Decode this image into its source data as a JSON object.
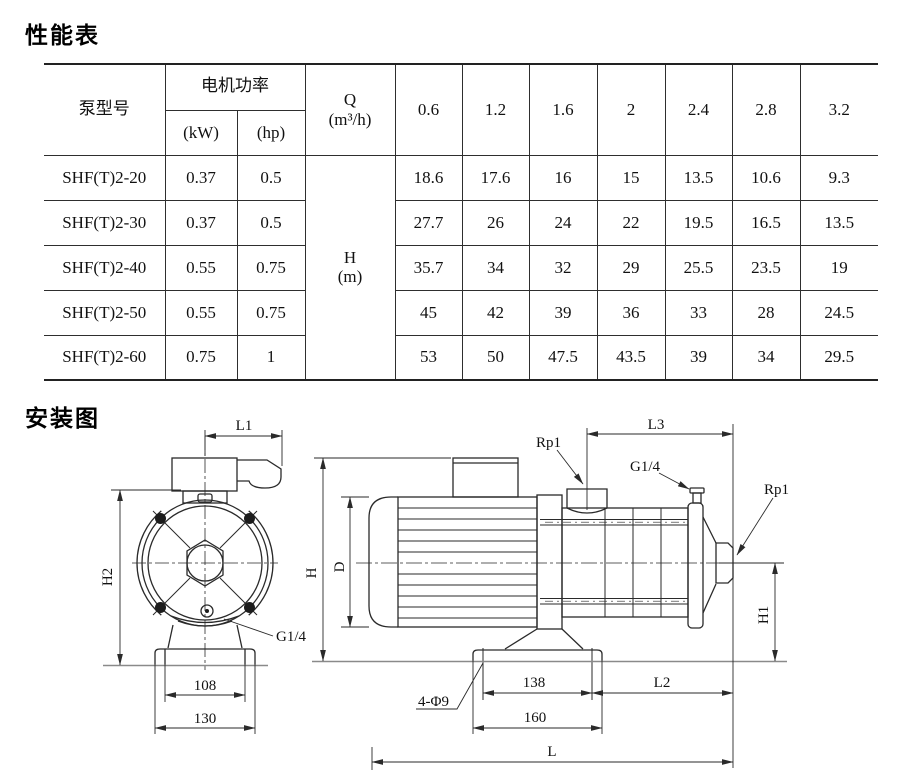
{
  "performance": {
    "title": "性能表",
    "header": {
      "pump_model": "泵型号",
      "motor_power": "电机功率",
      "kw": "(kW)",
      "hp": "(hp)",
      "q": "Q",
      "q_unit": "(m³/h)",
      "q_values": [
        "0.6",
        "1.2",
        "1.6",
        "2",
        "2.4",
        "2.8",
        "3.2"
      ]
    },
    "h_label": {
      "line1": "H",
      "line2": "(m)"
    },
    "rows": [
      {
        "model": "SHF(T)2-20",
        "kw": "0.37",
        "hp": "0.5",
        "h": [
          "18.6",
          "17.6",
          "16",
          "15",
          "13.5",
          "10.6",
          "9.3"
        ]
      },
      {
        "model": "SHF(T)2-30",
        "kw": "0.37",
        "hp": "0.5",
        "h": [
          "27.7",
          "26",
          "24",
          "22",
          "19.5",
          "16.5",
          "13.5"
        ]
      },
      {
        "model": "SHF(T)2-40",
        "kw": "0.55",
        "hp": "0.75",
        "h": [
          "35.7",
          "34",
          "32",
          "29",
          "25.5",
          "23.5",
          "19"
        ]
      },
      {
        "model": "SHF(T)2-50",
        "kw": "0.55",
        "hp": "0.75",
        "h": [
          "45",
          "42",
          "39",
          "36",
          "33",
          "28",
          "24.5"
        ]
      },
      {
        "model": "SHF(T)2-60",
        "kw": "0.75",
        "hp": "1",
        "h": [
          "53",
          "50",
          "47.5",
          "43.5",
          "39",
          "34",
          "29.5"
        ]
      }
    ]
  },
  "installation": {
    "title": "安装图",
    "front_view": {
      "l1": "L1",
      "h2": "H2",
      "g14": "G1/4",
      "d108": "108",
      "d130": "130"
    },
    "side_view": {
      "h": "H",
      "d": "D",
      "rp1_top": "Rp1",
      "g14": "G1/4",
      "l3": "L3",
      "rp1_right": "Rp1",
      "h1": "H1",
      "holes": "4-Φ9",
      "d138": "138",
      "d160": "160",
      "l2": "L2",
      "l": "L"
    }
  },
  "chart_data": {
    "type": "table",
    "title": "性能表",
    "categories_q_m3h": [
      0.6,
      1.2,
      1.6,
      2,
      2.4,
      2.8,
      3.2
    ],
    "series": [
      {
        "name": "SHF(T)2-20",
        "kw": 0.37,
        "hp": 0.5,
        "h_m": [
          18.6,
          17.6,
          16,
          15,
          13.5,
          10.6,
          9.3
        ]
      },
      {
        "name": "SHF(T)2-30",
        "kw": 0.37,
        "hp": 0.5,
        "h_m": [
          27.7,
          26,
          24,
          22,
          19.5,
          16.5,
          13.5
        ]
      },
      {
        "name": "SHF(T)2-40",
        "kw": 0.55,
        "hp": 0.75,
        "h_m": [
          35.7,
          34,
          32,
          29,
          25.5,
          23.5,
          19
        ]
      },
      {
        "name": "SHF(T)2-50",
        "kw": 0.55,
        "hp": 0.75,
        "h_m": [
          45,
          42,
          39,
          36,
          33,
          28,
          24.5
        ]
      },
      {
        "name": "SHF(T)2-60",
        "kw": 0.75,
        "hp": 1,
        "h_m": [
          53,
          50,
          47.5,
          43.5,
          39,
          34,
          29.5
        ]
      }
    ]
  },
  "colors": {
    "line": "#2a2a2a",
    "ground": "#8a8a8a",
    "text": "#111111"
  }
}
